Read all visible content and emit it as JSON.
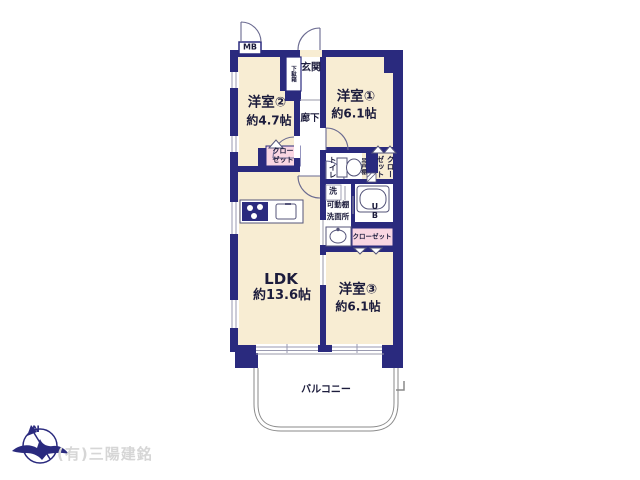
{
  "floorplan": {
    "rooms": {
      "room1": {
        "name": "洋室①",
        "size": "約6.1帖"
      },
      "room2": {
        "name": "洋室②",
        "size": "約4.7帖"
      },
      "room3": {
        "name": "洋室③",
        "size": "約6.1帖"
      },
      "ldk": {
        "name": "LDK",
        "size": "約13.6帖"
      },
      "balcony": {
        "name": "バルコニー"
      }
    },
    "features": {
      "mb": "MB",
      "entrance": "玄関",
      "shoe_cabinet": "下駄箱",
      "hallway": "廊下",
      "toilet": "トイレ",
      "hanging_shelf": "吊戸棚",
      "closet_room1": "クローゼット",
      "closet_room2": "クローゼット",
      "closet_room3": "クローゼット",
      "washer": "洗",
      "movable_shelf": "可動棚",
      "washroom": "洗面所",
      "unit_bath": "UB"
    }
  },
  "footer": {
    "compass_north": "N",
    "company": "(有)三陽建銘"
  },
  "colors": {
    "wall": "#2a2a7e",
    "room_fill": "#f8edd3",
    "closet_fill": "#f9d6e2",
    "text": "#1c1c3c",
    "company_text": "#d6d6d6"
  }
}
